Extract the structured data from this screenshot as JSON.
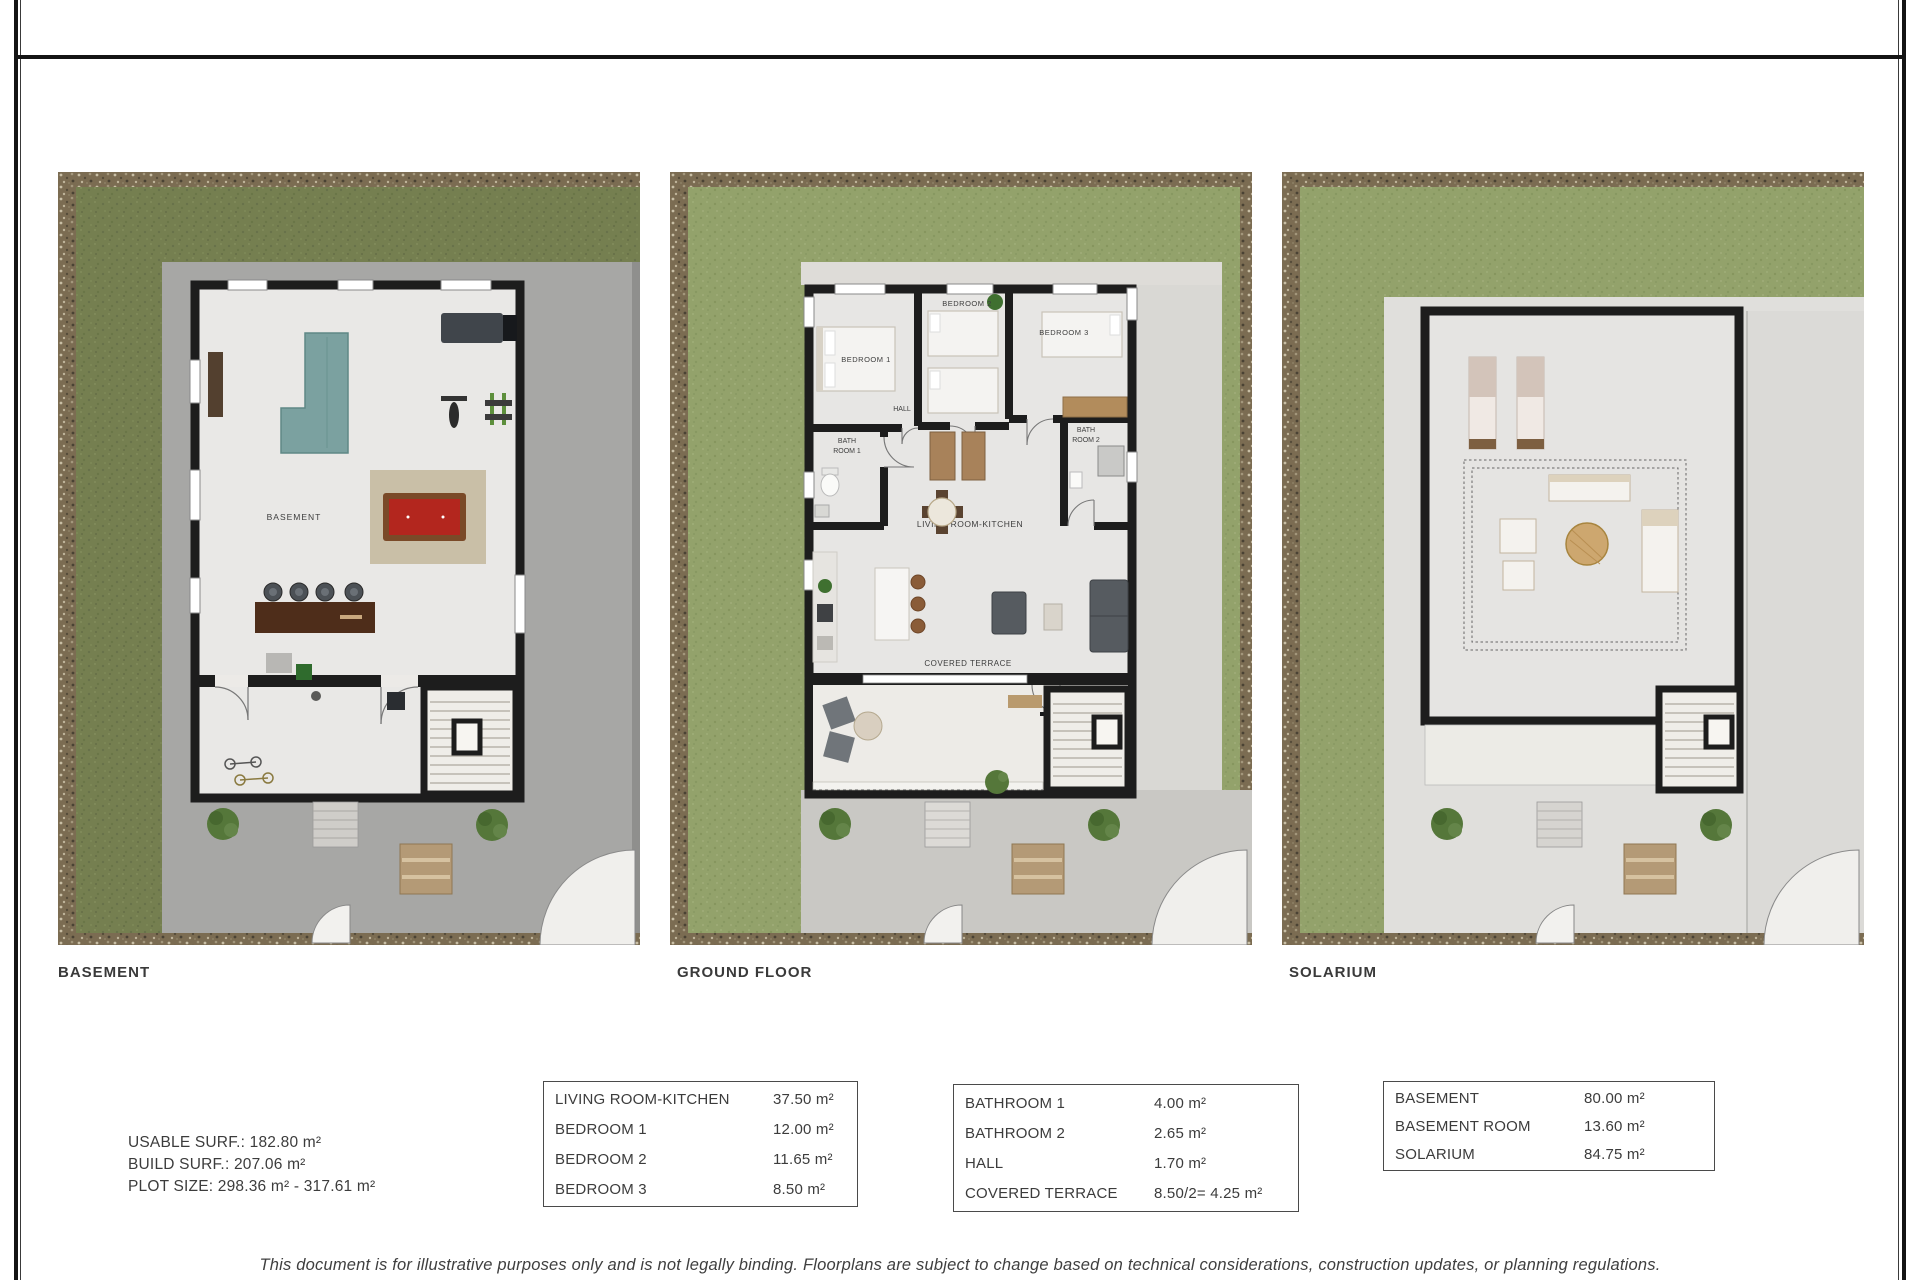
{
  "plans": {
    "basement": {
      "caption": "BASEMENT",
      "labels": {
        "room": "BASEMENT"
      }
    },
    "ground": {
      "caption": "GROUND FLOOR",
      "labels": {
        "bedroom1": "BEDROOM 1",
        "bedroom2": "BEDROOM 2",
        "bedroom3": "BEDROOM 3",
        "hall": "HALL",
        "bath1_line1": "BATH",
        "bath1_line2": "ROOM 1",
        "bath2_line1": "BATH",
        "bath2_line2": "ROOM 2",
        "living": "LIVING ROOM-KITCHEN",
        "terrace": "COVERED TERRACE"
      }
    },
    "solarium": {
      "caption": "SOLARIUM"
    }
  },
  "summary": {
    "usable": "USABLE SURF.: 182.80 m²",
    "build": "BUILD SURF.: 207.06 m²",
    "plot": "PLOT SIZE: 298.36 m² - 317.61 m²"
  },
  "tables": {
    "rooms": {
      "rows": [
        {
          "label": "LIVING ROOM-KITCHEN",
          "value": "37.50 m²"
        },
        {
          "label": "BEDROOM 1",
          "value": "12.00 m²"
        },
        {
          "label": "BEDROOM 2",
          "value": "11.65 m²"
        },
        {
          "label": "BEDROOM 3",
          "value": "8.50 m²"
        }
      ]
    },
    "wet_areas": {
      "rows": [
        {
          "label": "BATHROOM 1",
          "value": "4.00 m²"
        },
        {
          "label": "BATHROOM 2",
          "value": "2.65 m²"
        },
        {
          "label": "HALL",
          "value": "1.70 m²"
        },
        {
          "label": "COVERED TERRACE",
          "value": "8.50/2= 4.25 m²"
        }
      ]
    },
    "levels": {
      "rows": [
        {
          "label": "BASEMENT",
          "value": "80.00 m²"
        },
        {
          "label": "BASEMENT ROOM",
          "value": "13.60 m²"
        },
        {
          "label": "SOLARIUM",
          "value": "84.75 m²"
        }
      ]
    }
  },
  "disclaimer": "This document is for illustrative purposes only and is not legally binding. Floorplans are subject to change based on technical considerations, construction updates, or planning regulations.",
  "colors": {
    "grass_dark": "#757f50",
    "grass_light": "#93a26b",
    "stone_border": "#7b6c52",
    "wall": "#1d1d1d",
    "basement_concrete": "#a7a7a5",
    "pool_table_red": "#b3261e",
    "sofa_teal": "#7ba1a0"
  }
}
